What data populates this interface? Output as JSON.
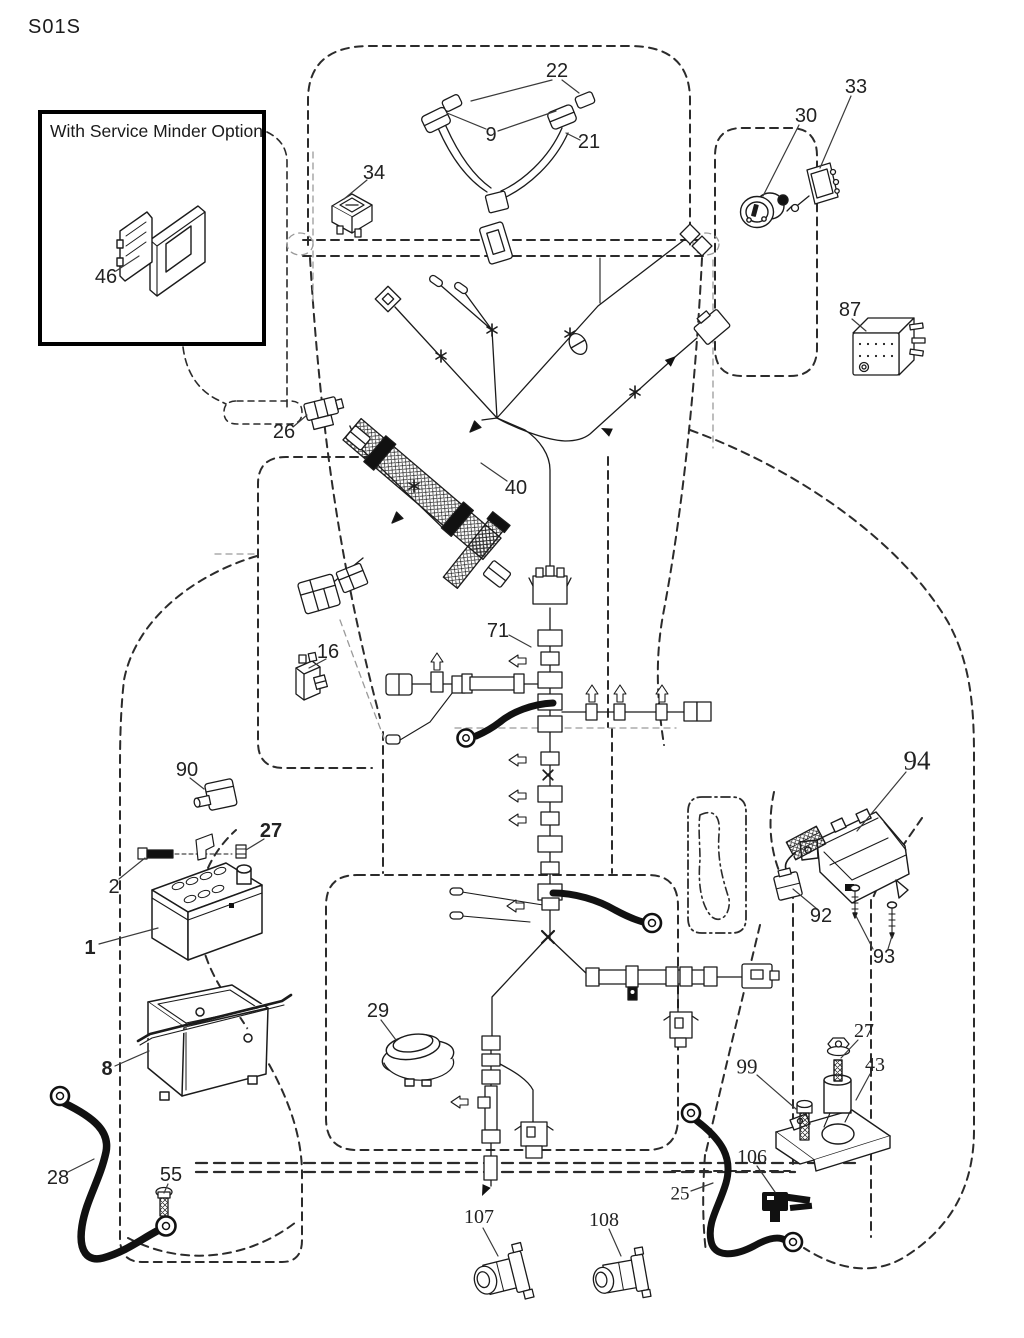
{
  "page": {
    "code": "S01S"
  },
  "inset": {
    "title": "With Service Minder Option"
  },
  "colors": {
    "ink": "#1b1b1b",
    "ghost": "#2b2b2b",
    "faint": "#9a9a9a",
    "paper": "#ffffff",
    "cable": "#111111"
  },
  "labels": [
    {
      "id": "22",
      "text": "22",
      "x": 557,
      "y": 71,
      "font": "sans",
      "bold": false,
      "size": 20
    },
    {
      "id": "9",
      "text": "9",
      "x": 491,
      "y": 135,
      "font": "sans",
      "bold": false,
      "size": 20
    },
    {
      "id": "21",
      "text": "21",
      "x": 589,
      "y": 142,
      "font": "sans",
      "bold": false,
      "size": 20
    },
    {
      "id": "34",
      "text": "34",
      "x": 374,
      "y": 173,
      "font": "sans",
      "bold": false,
      "size": 20
    },
    {
      "id": "30",
      "text": "30",
      "x": 806,
      "y": 116,
      "font": "sans",
      "bold": false,
      "size": 20
    },
    {
      "id": "33",
      "text": "33",
      "x": 856,
      "y": 87,
      "font": "sans",
      "bold": false,
      "size": 20
    },
    {
      "id": "87",
      "text": "87",
      "x": 850,
      "y": 310,
      "font": "sans",
      "bold": false,
      "size": 20
    },
    {
      "id": "26",
      "text": "26",
      "x": 284,
      "y": 432,
      "font": "sans",
      "bold": false,
      "size": 20
    },
    {
      "id": "40",
      "text": "40",
      "x": 516,
      "y": 488,
      "font": "sans",
      "bold": false,
      "size": 20
    },
    {
      "id": "71",
      "text": "71",
      "x": 498,
      "y": 631,
      "font": "sans",
      "bold": false,
      "size": 20
    },
    {
      "id": "16",
      "text": "16",
      "x": 328,
      "y": 652,
      "font": "sans",
      "bold": false,
      "size": 20
    },
    {
      "id": "90",
      "text": "90",
      "x": 187,
      "y": 770,
      "font": "sans",
      "bold": false,
      "size": 20
    },
    {
      "id": "27-battery",
      "text": "27",
      "x": 271,
      "y": 831,
      "font": "sans",
      "bold": true,
      "size": 20
    },
    {
      "id": "2",
      "text": "2",
      "x": 114,
      "y": 887,
      "font": "sans",
      "bold": false,
      "size": 20
    },
    {
      "id": "1",
      "text": "1",
      "x": 90,
      "y": 948,
      "font": "sans",
      "bold": true,
      "size": 20
    },
    {
      "id": "8",
      "text": "8",
      "x": 107,
      "y": 1069,
      "font": "sans",
      "bold": true,
      "size": 20
    },
    {
      "id": "29",
      "text": "29",
      "x": 378,
      "y": 1011,
      "font": "sans",
      "bold": false,
      "size": 20
    },
    {
      "id": "28",
      "text": "28",
      "x": 58,
      "y": 1178,
      "font": "sans",
      "bold": false,
      "size": 20
    },
    {
      "id": "55",
      "text": "55",
      "x": 171,
      "y": 1175,
      "font": "sans",
      "bold": false,
      "size": 20
    },
    {
      "id": "92",
      "text": "92",
      "x": 821,
      "y": 916,
      "font": "sans",
      "bold": false,
      "size": 20
    },
    {
      "id": "93",
      "text": "93",
      "x": 884,
      "y": 957,
      "font": "sans",
      "bold": false,
      "size": 20
    },
    {
      "id": "94",
      "text": "94",
      "x": 917,
      "y": 761,
      "font": "serif",
      "bold": false,
      "size": 27
    },
    {
      "id": "99",
      "text": "99",
      "x": 747,
      "y": 1067,
      "font": "serif",
      "bold": false,
      "size": 21
    },
    {
      "id": "27-solenoid",
      "text": "27",
      "x": 864,
      "y": 1031,
      "font": "serif",
      "bold": false,
      "size": 20
    },
    {
      "id": "43",
      "text": "43",
      "x": 875,
      "y": 1065,
      "font": "serif",
      "bold": false,
      "size": 20
    },
    {
      "id": "106",
      "text": "106",
      "x": 752,
      "y": 1157,
      "font": "serif",
      "bold": false,
      "size": 20
    },
    {
      "id": "25",
      "text": "25",
      "x": 680,
      "y": 1194,
      "font": "serif",
      "bold": false,
      "size": 19
    },
    {
      "id": "107",
      "text": "107",
      "x": 479,
      "y": 1217,
      "font": "serif",
      "bold": false,
      "size": 20
    },
    {
      "id": "108",
      "text": "108",
      "x": 604,
      "y": 1220,
      "font": "serif",
      "bold": false,
      "size": 20
    },
    {
      "id": "46",
      "text": "46",
      "x": 106,
      "y": 277,
      "font": "sans",
      "bold": false,
      "size": 20
    }
  ]
}
